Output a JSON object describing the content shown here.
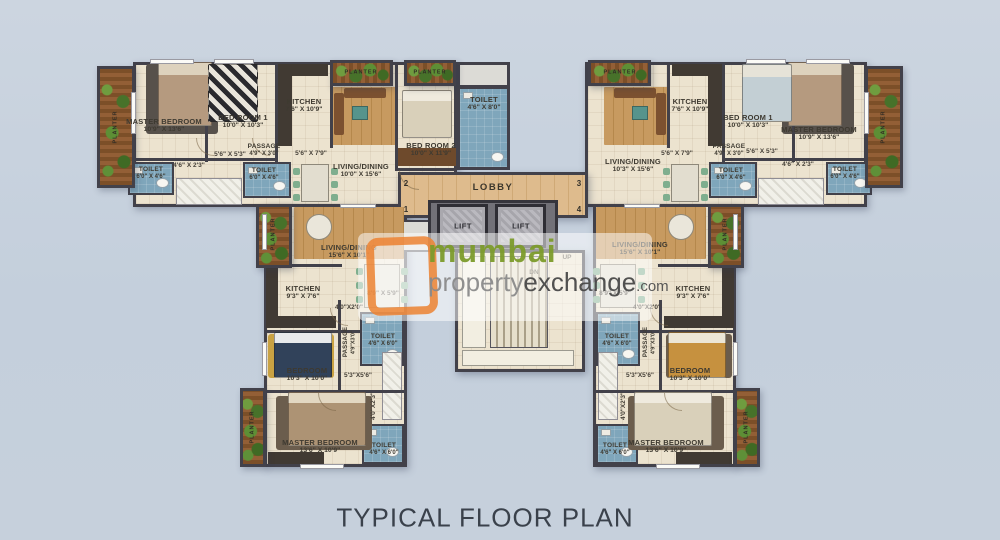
{
  "title": "TYPICAL FLOOR PLAN",
  "watermark": {
    "brand_top": "mumbai",
    "brand_property": "property",
    "brand_exchange": "exchange",
    "brand_suffix": ".com"
  },
  "core": {
    "lobby": "LOBBY",
    "lift": "LIFT",
    "up": "UP",
    "dn": "DN",
    "flat_numbers": {
      "tl": "2",
      "tr": "3",
      "bl": "1",
      "br": "4"
    }
  },
  "planter_label": "PLANTER",
  "units": {
    "top_left": {
      "master_bedroom": {
        "name": "MASTER BEDROOM",
        "dims": "10'9\" X 13'6\""
      },
      "bedroom1": {
        "name": "BED ROOM 1",
        "dims": "10'0\" X 10'3\""
      },
      "kitchen": {
        "name": "KITCHEN",
        "dims": "7'6\" X 10'9\""
      },
      "bedroom2": {
        "name": "BED ROOM 2",
        "dims": "10'0\" X 11'9\""
      },
      "toilet_attached": {
        "name": "TOILET",
        "dims": "4'6\" X 8'0\""
      },
      "living": {
        "name": "LIVING/DINING",
        "dims": "10'0\" X 15'6\""
      },
      "passage": {
        "name": "PASSAGE",
        "dims": "4'9\" X 3'0\""
      },
      "toilet_common": {
        "name": "TOILET",
        "dims": "6'0\" X 4'6\""
      },
      "toilet_master": {
        "name": "TOILET",
        "dims": "6'0\" X 4'6\""
      },
      "dim_foyer": "5'6\" X 5'3\"",
      "dim_store": "5'6\" X 7'9\"",
      "dim_niche": "4'6\" X 2'3\""
    },
    "top_right": {
      "master_bedroom": {
        "name": "MASTER BEDROOM",
        "dims": "10'9\" X 13'6\""
      },
      "bedroom1": {
        "name": "BED ROOM 1",
        "dims": "10'0\" X 10'3\""
      },
      "kitchen": {
        "name": "KITCHEN",
        "dims": "7'6\" X 10'9\""
      },
      "living": {
        "name": "LIVING/DINING",
        "dims": "10'3\" X 15'6\""
      },
      "passage": {
        "name": "PASSAGE",
        "dims": "4'9\" X 3'0\""
      },
      "toilet_common": {
        "name": "TOILET",
        "dims": "6'0\" X 4'6\""
      },
      "toilet_master": {
        "name": "TOILET",
        "dims": "6'0\" X 4'6\""
      },
      "dim_foyer": "5'6\" X 5'3\"",
      "dim_store": "5'6\" X 7'9\"",
      "dim_niche": "4'6\" X 2'3\""
    },
    "bottom_left": {
      "living": {
        "name": "LIVING/DINING",
        "dims": "15'6\" X 10'1\""
      },
      "kitchen": {
        "name": "KITCHEN",
        "dims": "9'3\" X 7'6\""
      },
      "dining_dim": "8'9\" X 5'9\"",
      "passage": {
        "name": "PASSAGE",
        "dims": "4'9\"X3'0\""
      },
      "toilet_common": {
        "name": "TOILET",
        "dims": "4'6\" X 6'0\""
      },
      "toilet_master": {
        "name": "TOILET",
        "dims": "4'6\" X 6'0\""
      },
      "bedroom": {
        "name": "BEDROOM",
        "dims": "10'3\" X 10'0\""
      },
      "master_bedroom": {
        "name": "MASTER BEDROOM",
        "dims": "13'6\" X 10'9\""
      },
      "dim_pass1": "4'0\"X2'0\"",
      "dim_hall": "5'3\"X5'6\"",
      "dim_pass2": "4'0\"X2'3\""
    },
    "bottom_right": {
      "living": {
        "name": "LIVING/DINING",
        "dims": "15'6\" X 10'1\""
      },
      "kitchen": {
        "name": "KITCHEN",
        "dims": "9'3\" X 7'6\""
      },
      "dining_dim": "8'9\" X 5'9\"",
      "passage": {
        "name": "PASSAGE",
        "dims": "4'9\"X3'0\""
      },
      "toilet_common": {
        "name": "TOILET",
        "dims": "4'6\" X 6'0\""
      },
      "toilet_master": {
        "name": "TOILET",
        "dims": "4'6\" X 6'0\""
      },
      "bedroom": {
        "name": "BEDROOM",
        "dims": "10'3\" X 10'0\""
      },
      "master_bedroom": {
        "name": "MASTER BEDROOM",
        "dims": "13'6\" X 10'9\""
      },
      "dim_pass1": "4'0\"X2'0\"",
      "dim_hall": "5'3\"X5'6\"",
      "dim_pass2": "4'0\"X2'3\""
    }
  }
}
